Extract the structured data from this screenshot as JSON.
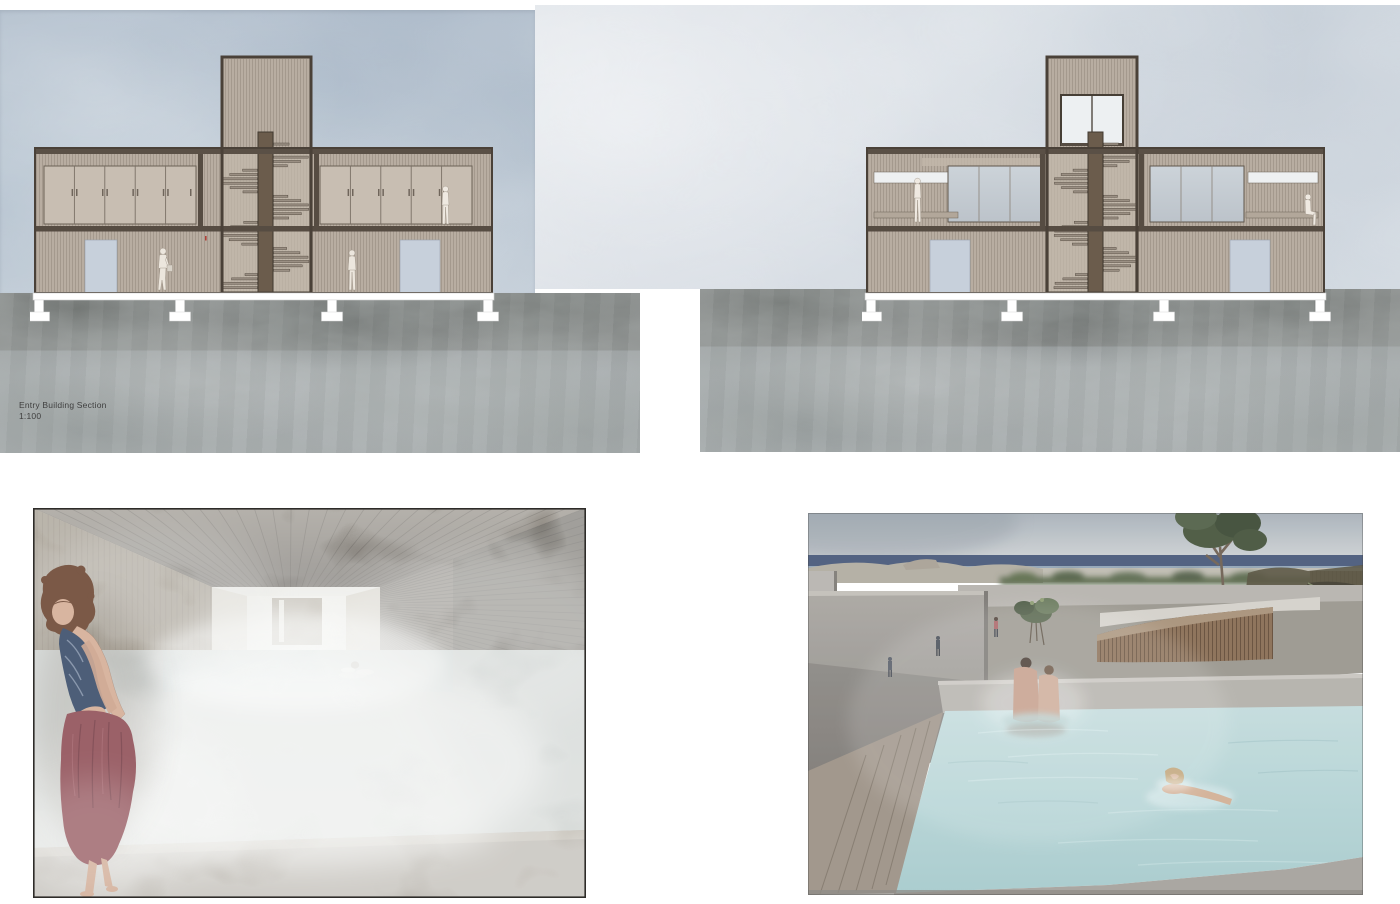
{
  "board": {
    "type": "architecture-presentation-sheet",
    "background": "#ffffff"
  },
  "drawings": {
    "entry_building_section": {
      "caption": "Entry Building Section",
      "scale": "1:100"
    },
    "second_building_section": {
      "caption": "",
      "scale": ""
    }
  },
  "renders": {
    "interior_steam_pool": {
      "label": "interior-steam-pool-render"
    },
    "exterior_pool": {
      "label": "exterior-pool-render"
    }
  },
  "palette": {
    "sky_left": "#aebdcb",
    "sky_right": "#ccd4dd",
    "terrain_dark_band": "#8a8d8c",
    "terrain_light_band": "#a9aeb0",
    "wall_tan": "#b8ada1",
    "frame_brown": "#4a4138",
    "stair_column_brown": "#6b5c4c",
    "cabinet_tan": "#c8beb2",
    "door_blue": "#c7d0db",
    "glazing_gray": "#c6cdd3",
    "stilt_white": "#ffffff",
    "interior_wood": "#9a8c77",
    "steam_white": "#e8e9e6",
    "towel_red": "#9b6168",
    "swimsuit_blue": "#4d5e78",
    "sea_blue": "#4a5b7c",
    "pool_water": "#b5d3d6",
    "concrete": "#a8a5a0",
    "wood_fence": "#8a6e55",
    "foliage_green": "#49573f"
  }
}
